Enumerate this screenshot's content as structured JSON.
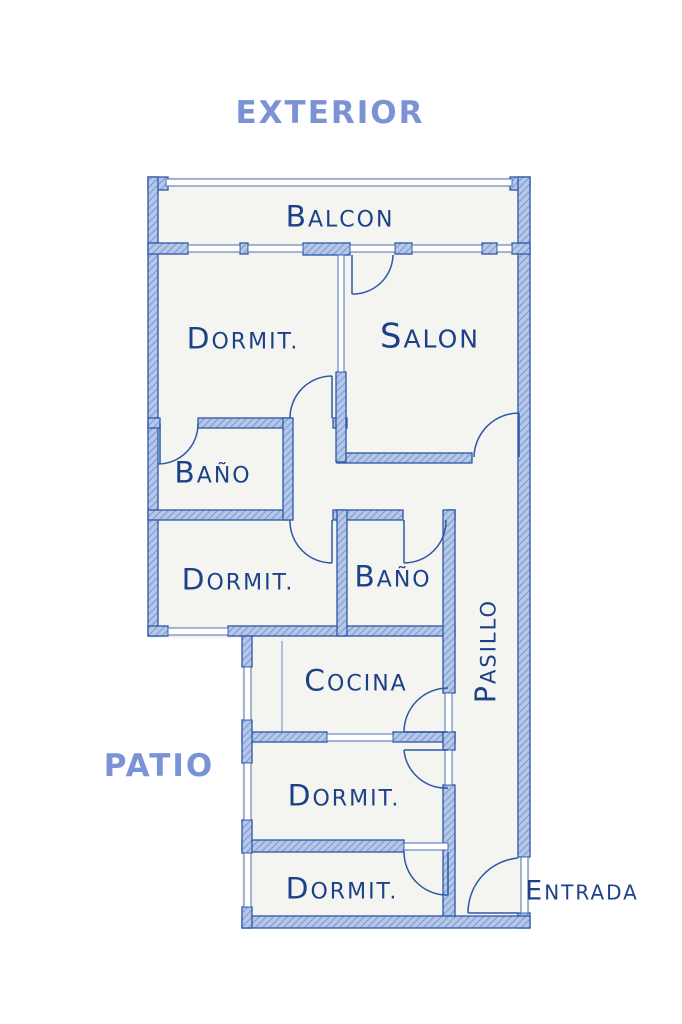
{
  "plan": {
    "area_labels": {
      "exterior": "EXTERIOR",
      "patio": "PATIO"
    },
    "rooms": {
      "balcon": "Balcon",
      "dormit_top": "Dormit.",
      "salon": "Salon",
      "bano_top": "Baño",
      "dormit_mid": "Dormit.",
      "bano_mid": "Baño",
      "cocina": "Cocina",
      "pasillo": "Pasillo",
      "dormit_lower": "Dormit.",
      "dormit_bottom": "Dormit.",
      "entrada": "Entrada"
    },
    "colors": {
      "wall_fill": "#b7c7e7",
      "wall_hatch": "#7e9ad2",
      "wall_outline": "#2d58a7",
      "ink": "#1d4189",
      "area_label_blue": "#7b92d4",
      "floor": "#f4f4f0"
    }
  }
}
